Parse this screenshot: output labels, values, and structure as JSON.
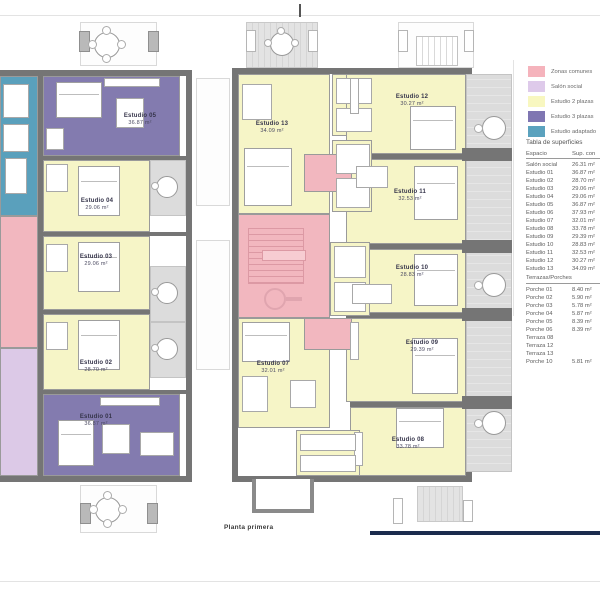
{
  "page": {
    "caption": "Planta primera",
    "colors": {
      "navy_bar": "#1b2b4d",
      "wall": "#757575"
    }
  },
  "legend": {
    "items": [
      {
        "label": "Zonas comunes",
        "color": "#F5B3BC"
      },
      {
        "label": "Salón social",
        "color": "#DECAEA"
      },
      {
        "label": "Estudio 2 plazas",
        "color": "#F8F7C0"
      },
      {
        "label": "Estudio 3 plazas",
        "color": "#7F76B2"
      },
      {
        "label": "Estudio adaptado",
        "color": "#5BA2BE"
      }
    ]
  },
  "surface_table": {
    "title": "Tabla de superficies",
    "col_espacio": "Espacio",
    "col_sup": "Sup. con",
    "rows": [
      [
        "Salón social",
        "26.31 m²"
      ],
      [
        "Estudio 01",
        "36.87 m²"
      ],
      [
        "Estudio 02",
        "28.70 m²"
      ],
      [
        "Estudio 03",
        "29.06 m²"
      ],
      [
        "Estudio 04",
        "29.06 m²"
      ],
      [
        "Estudio 05",
        "36.87 m²"
      ],
      [
        "Estudio 06",
        "37.93 m²"
      ],
      [
        "Estudio 07",
        "32.01 m²"
      ],
      [
        "Estudio 08",
        "33.78 m²"
      ],
      [
        "Estudio 09",
        "29.39 m²"
      ],
      [
        "Estudio 10",
        "28.83 m²"
      ],
      [
        "Estudio 11",
        "32.53 m²"
      ],
      [
        "Estudio 12",
        "30.27 m²"
      ],
      [
        "Estudio 13",
        "34.09 m²"
      ]
    ],
    "section2": "Terrazas/Porches",
    "rows2": [
      [
        "Porche 01",
        "8.40 m²"
      ],
      [
        "Porche 02",
        "5.90 m²"
      ],
      [
        "Porche 03",
        "5.78 m²"
      ],
      [
        "Porche 04",
        "5.87 m²"
      ],
      [
        "Porche 05",
        "8.39 m²"
      ],
      [
        "Porche 06",
        "8.39 m²"
      ],
      [
        "Terraza 08",
        ""
      ],
      [
        "Terraza 12",
        ""
      ],
      [
        "Terraza 13",
        ""
      ],
      [
        "Porche 10",
        "5.81 m²"
      ]
    ]
  },
  "plan": {
    "units": {
      "e01": {
        "name": "Estudio 01",
        "area": "36.87 m²"
      },
      "e02": {
        "name": "Estudio 02",
        "area": "28.70 m²"
      },
      "e03": {
        "name": "Estudio 03",
        "area": "29.06 m²"
      },
      "e04": {
        "name": "Estudio 04",
        "area": "29.06 m²"
      },
      "e05": {
        "name": "Estudio 05",
        "area": "36.87 m²"
      },
      "e07": {
        "name": "Estudio 07",
        "area": "32.01 m²"
      },
      "e08": {
        "name": "Estudio 08",
        "area": "33.78 m²"
      },
      "e09": {
        "name": "Estudio 09",
        "area": "29.39 m²"
      },
      "e10": {
        "name": "Estudio 10",
        "area": "28.83 m²"
      },
      "e11": {
        "name": "Estudio 11",
        "area": "32.53 m²"
      },
      "e12": {
        "name": "Estudio 12",
        "area": "30.27 m²"
      },
      "e13": {
        "name": "Estudio 13",
        "area": "34.09 m²"
      }
    }
  }
}
